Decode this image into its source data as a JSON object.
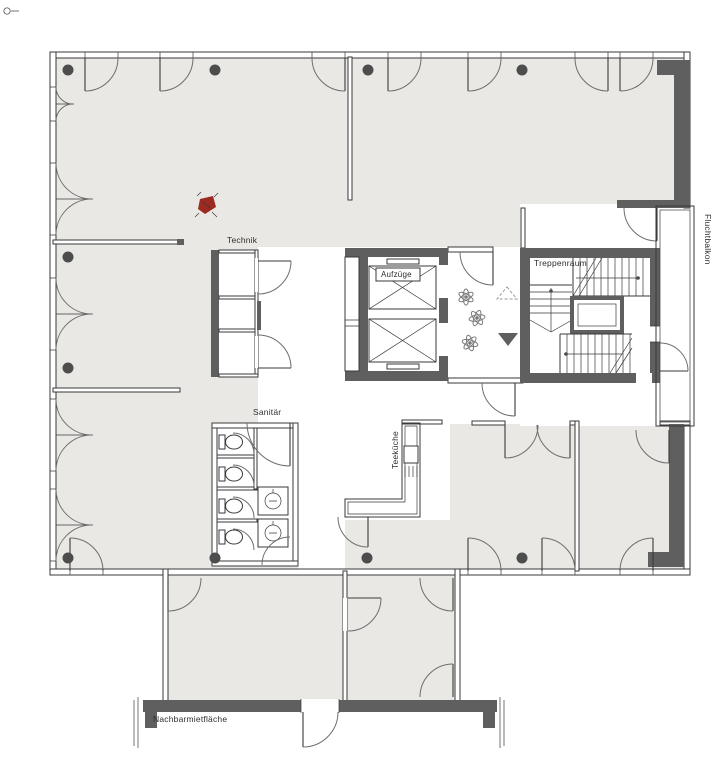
{
  "labels": {
    "technik": "Technik",
    "aufzuege": "Aufzüge",
    "treppenraum": "Treppenraum",
    "fluchtbalkon": "Fluchtbalkon",
    "sanitaer": "Sanitär",
    "teekueche": "Teeküche",
    "nachbarmietflaeche": "Nachbarmietfläche"
  },
  "colors": {
    "background": "#ffffff",
    "floor": "#e9e8e5",
    "wall_line": "#3a3a3a",
    "dark_wall": "#5f5f5f",
    "column": "#4d4d4d",
    "door_arc": "#6e6e6e",
    "marker_red": "#9b2a20",
    "label_text": "#2e2e2e"
  },
  "symbols": {
    "elevator_car": "x-crossed-rectangle",
    "plant": "leaf-burst",
    "stair_direction_up": "triangle-outline-up",
    "stair_direction_down": "triangle-filled-down",
    "toilet": "tank-and-bowl",
    "sink": "box-with-circle",
    "column": "filled-circle",
    "counts": {
      "elevators": 2,
      "plants": 3,
      "toilets": 4,
      "sinks": 2,
      "columns": 10
    }
  }
}
